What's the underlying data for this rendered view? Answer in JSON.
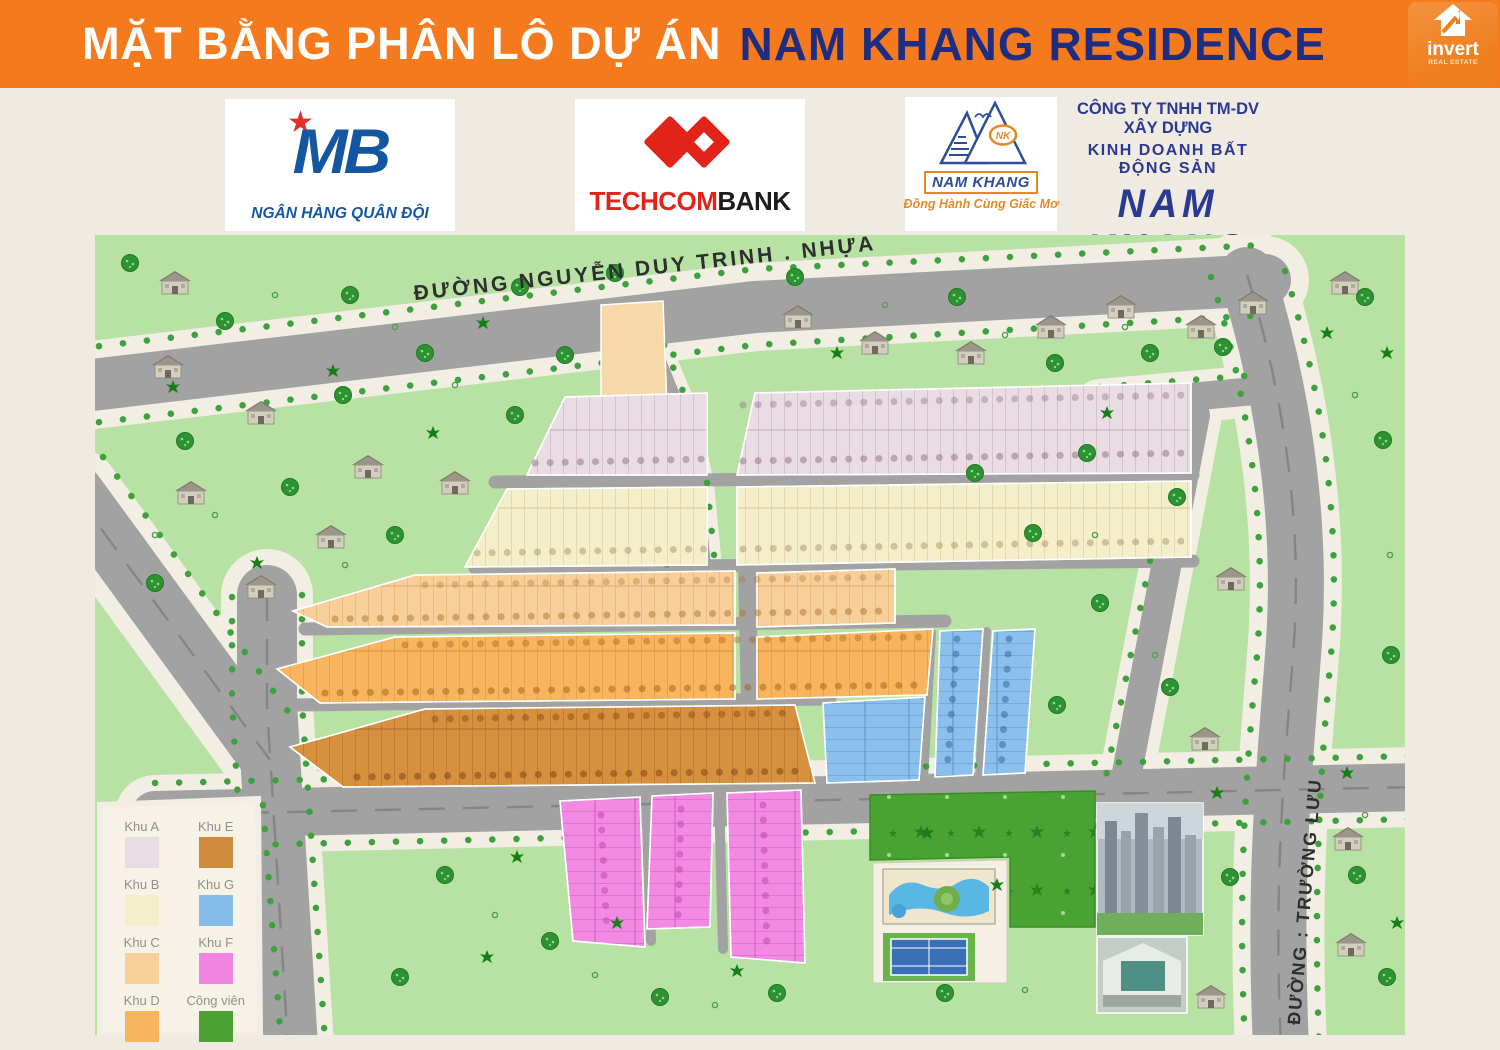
{
  "header": {
    "title_white": "MẶT BẰNG PHÂN LÔ DỰ ÁN",
    "title_navy": "NAM KHANG RESIDENCE",
    "brand": {
      "name": "invert",
      "sub": "REAL ESTATE"
    }
  },
  "sponsors": {
    "mb": {
      "letters": "MB",
      "tagline": "NGÂN HÀNG QUÂN ĐỘI"
    },
    "techcombank": {
      "part_red": "TECHCOM",
      "part_black": "BANK"
    },
    "namkhang_logo": {
      "name": "NAM KHANG",
      "nk": "NK",
      "tagline": "Đồng Hành Cùng Giấc Mơ"
    },
    "company": {
      "line1": "CÔNG TY TNHH TM-DV XÂY DỰNG",
      "line2": "KINH DOANH BẤT ĐỘNG SẢN",
      "name": "NAM KHANG",
      "address": "236 Đình Phong Phú, P. Tăng Nhơn Phú B, Quận 9"
    }
  },
  "map": {
    "roads": {
      "main": "ĐƯỜNG NGUYỄN DUY TRINH . NHỰA",
      "side": "ĐƯỜNG : TRƯỜNG LƯU"
    },
    "legend": {
      "items": [
        {
          "label": "Khu A",
          "color": "#e9dce3"
        },
        {
          "label": "Khu E",
          "color": "#d08a3e"
        },
        {
          "label": "Khu B",
          "color": "#f4eecb"
        },
        {
          "label": "Khu G",
          "color": "#85bce9"
        },
        {
          "label": "Khu C",
          "color": "#f8cf9b"
        },
        {
          "label": "Khu F",
          "color": "#f086e2"
        },
        {
          "label": "Khu D",
          "color": "#f8b55e"
        },
        {
          "label": "Công viên",
          "color": "#4ba132"
        }
      ]
    }
  }
}
